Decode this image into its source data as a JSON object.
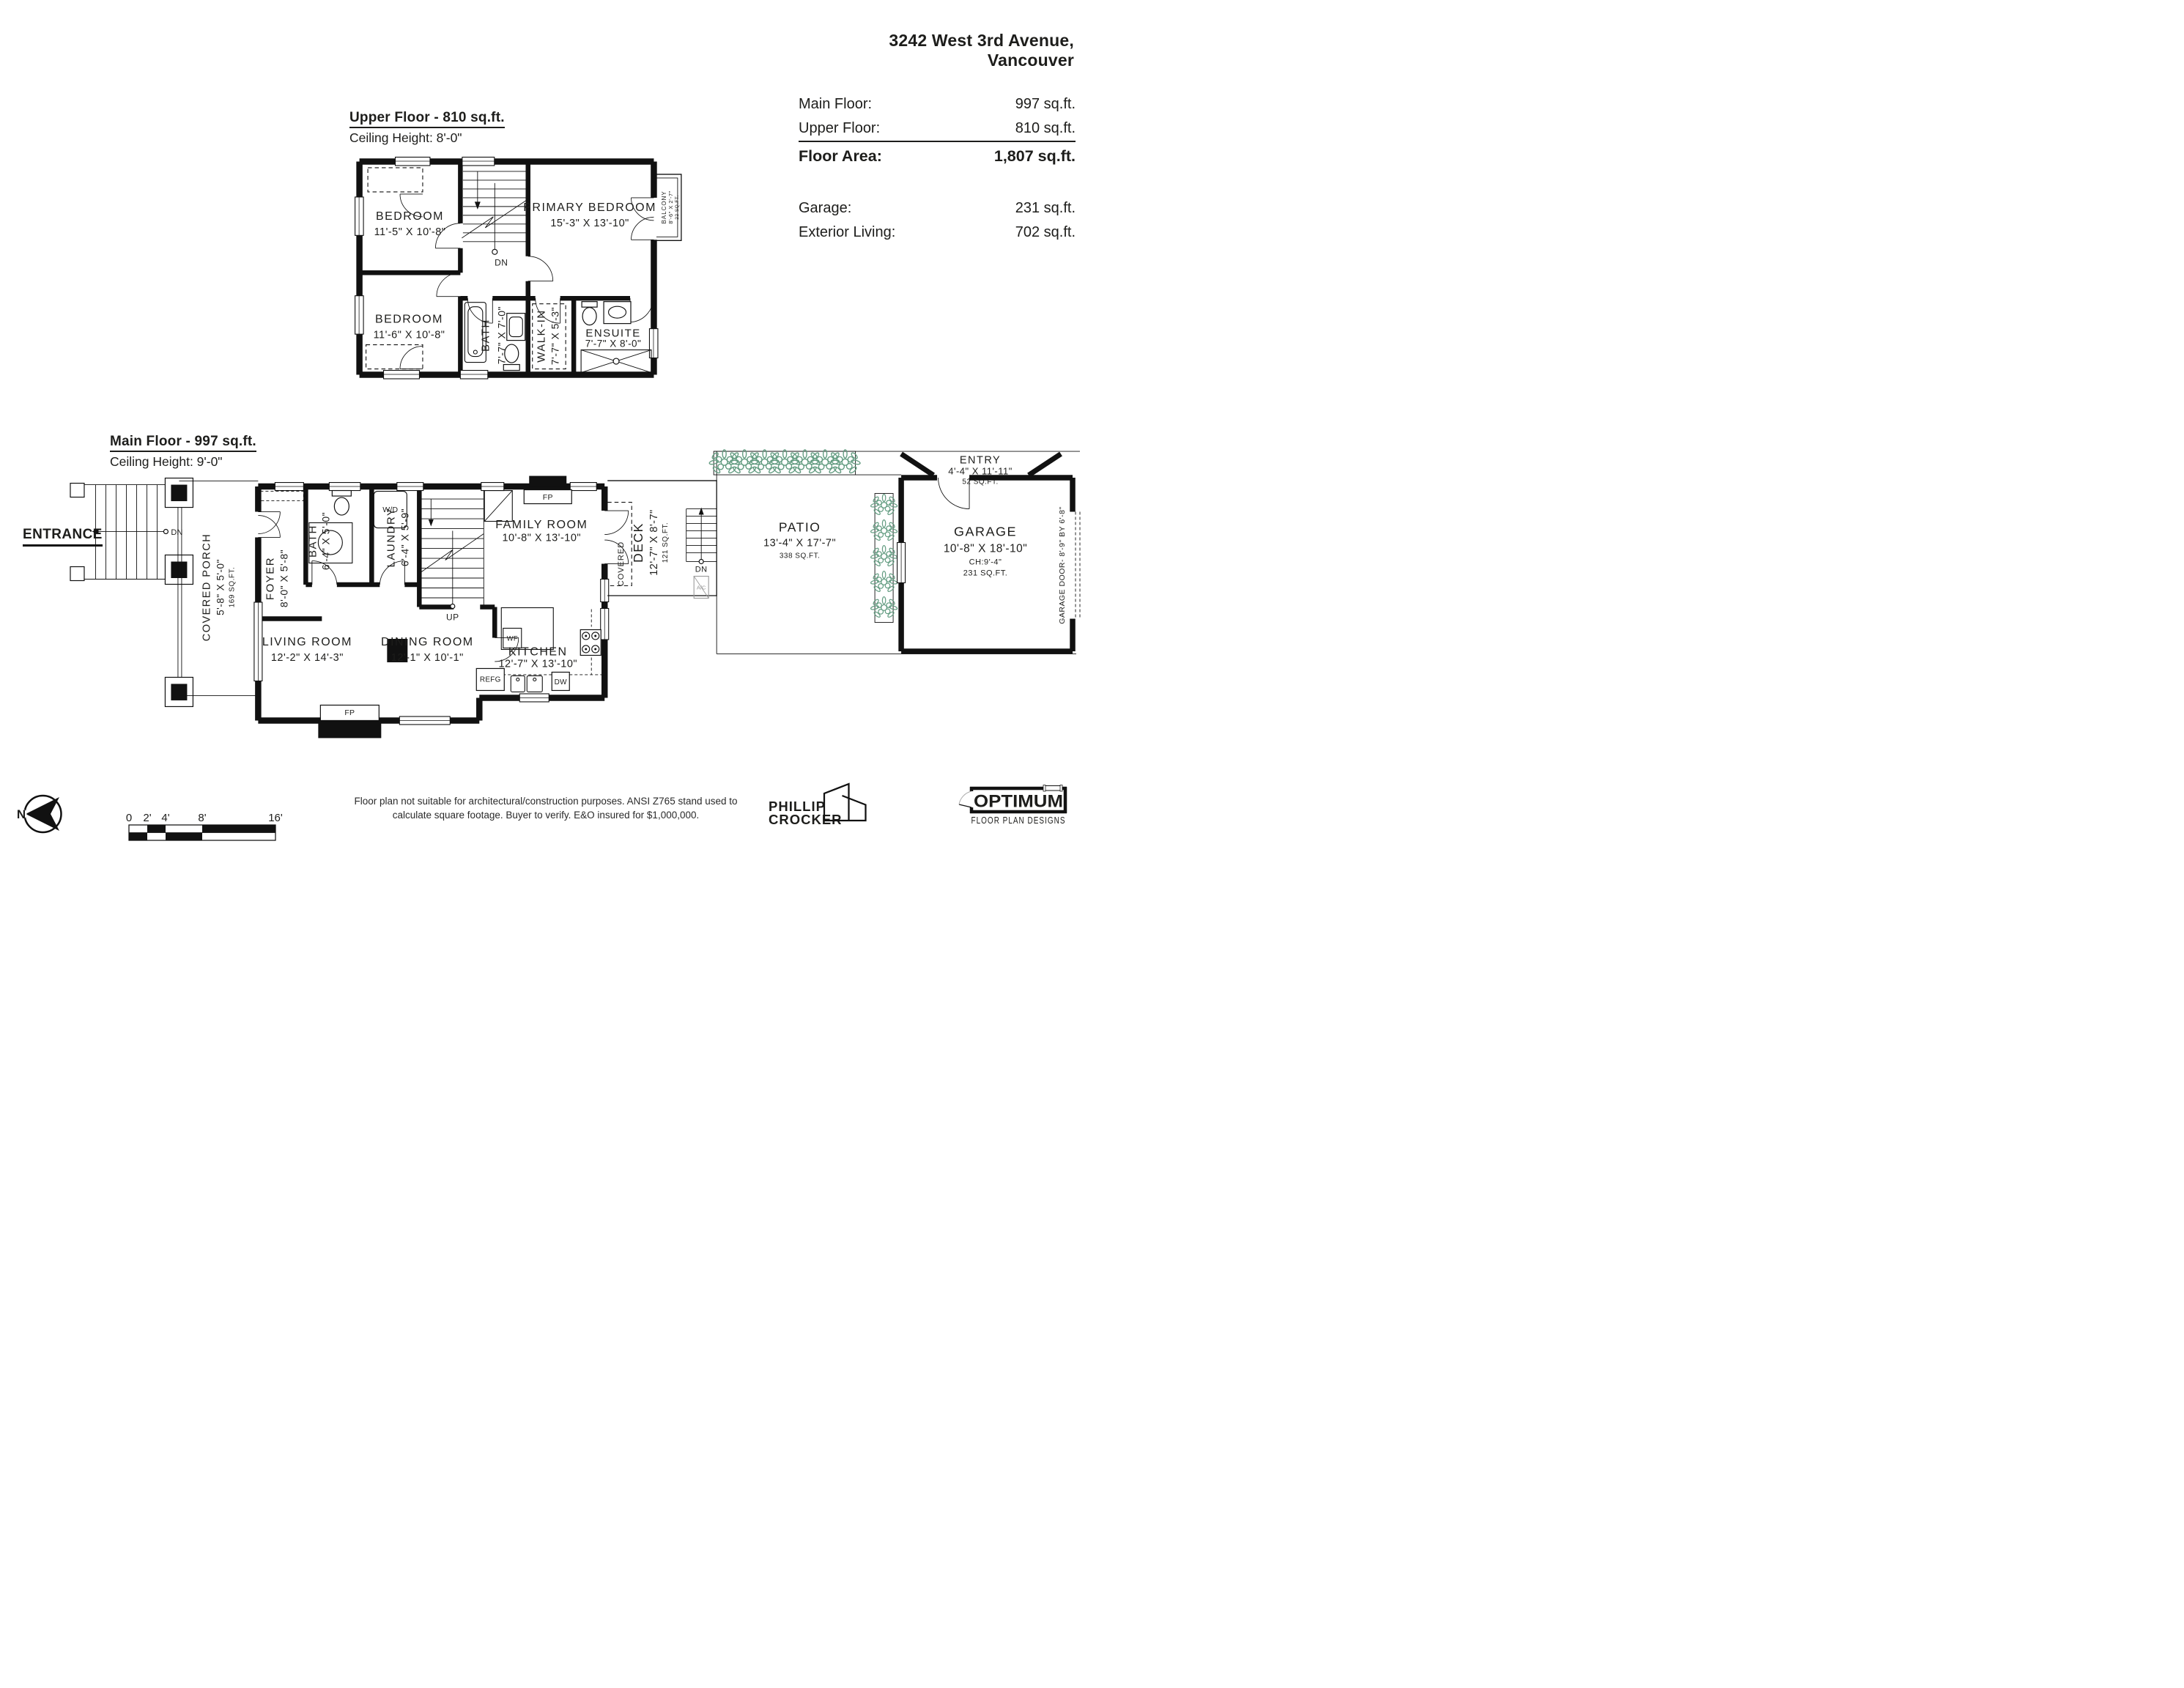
{
  "header": {
    "address_line1": "3242 West 3rd Avenue,",
    "address_line2": "Vancouver",
    "summary": [
      {
        "label": "Main Floor:",
        "value": "997 sq.ft."
      },
      {
        "label": "Upper Floor:",
        "value": "810 sq.ft."
      },
      {
        "label": "Floor Area:",
        "value": "1,807 sq.ft."
      },
      {
        "label": "Garage:",
        "value": "231 sq.ft."
      },
      {
        "label": "Exterior Living:",
        "value": "702 sq.ft."
      }
    ]
  },
  "upper_floor": {
    "title": "Upper Floor - 810 sq.ft.",
    "ceiling": "Ceiling Height: 8'-0\"",
    "stairs_label": "DN",
    "rooms": {
      "bedroom1": {
        "name": "BEDROOM",
        "dims": "11'-5\" X 10'-8\""
      },
      "bedroom2": {
        "name": "BEDROOM",
        "dims": "11'-6\" X 10'-8\""
      },
      "primary": {
        "name": "PRIMARY BEDROOM",
        "dims": "15'-3\" X 13'-10\""
      },
      "bath": {
        "name": "BATH",
        "dims": "7'-7\" X 7'-0\""
      },
      "walkin": {
        "name": "WALK-IN",
        "dims": "7'-7\" X 5'-3\""
      },
      "ensuite": {
        "name": "ENSUITE",
        "dims": "7'-7\" X 8'-0\""
      },
      "balcony": {
        "name": "BALCONY",
        "dims": "8'-6\" X 2'-7\"",
        "area": "22 SQ.FT."
      }
    }
  },
  "main_floor": {
    "title": "Main Floor - 997 sq.ft.",
    "ceiling": "Ceiling Height: 9'-0\"",
    "entrance_label": "ENTRANCE",
    "rooms": {
      "covered_porch": {
        "name": "COVERED PORCH",
        "dims": "5'-8\" X 5'-0\"",
        "area": "169 SQ.FT."
      },
      "foyer": {
        "name": "FOYER",
        "dims": "8'-0\" X 5'-8\""
      },
      "bath": {
        "name": "BATH",
        "dims": "6'-4\" X 5'-0\""
      },
      "laundry": {
        "name": "LAUNDRY",
        "dims": "6'-4\" X 5'-9\""
      },
      "living": {
        "name": "LIVING ROOM",
        "dims": "12'-2\" X 14'-3\""
      },
      "dining": {
        "name": "DINING ROOM",
        "dims": "12'-1\" X 10'-1\""
      },
      "family": {
        "name": "FAMILY ROOM",
        "dims": "10'-8\" X 13'-10\""
      },
      "kitchen": {
        "name": "KITCHEN",
        "dims": "12'-7\" X 13'-10\""
      },
      "deck": {
        "name": "DECK",
        "dims": "12'-7\" X 8'-7\"",
        "area": "121 SQ.FT."
      },
      "patio": {
        "name": "PATIO",
        "dims": "13'-4\" X 17'-7\"",
        "area": "338 SQ.FT."
      },
      "entry": {
        "name": "ENTRY",
        "dims": "4'-4\" X 11'-11\"",
        "area": "52 SQ.FT."
      },
      "garage": {
        "name": "GARAGE",
        "dims": "10'-8\" X 18'-10\"",
        "ceiling": "CH:9'-4\"",
        "area": "231 SQ.FT."
      }
    },
    "labels": {
      "up": "UP",
      "dn": "DN",
      "covered": "COVERED",
      "wd": "W/D",
      "fp": "FP",
      "wf": "WF",
      "refg": "REFG",
      "dw": "DW",
      "ac": "A/C",
      "garage_door": "GARAGE DOOR- 8'-9\" BY 6'-8\""
    }
  },
  "footer": {
    "north_label": "N",
    "scale_ticks": [
      "0",
      "2'",
      "4'",
      "8'",
      "16'"
    ],
    "disclaimer_line1": "Floor plan not suitable for architectural/construction purposes. ANSI Z765 stand used to",
    "disclaimer_line2": "calculate square footage. Buyer to verify.  E&O insured for $1,000,000.",
    "credit_line1": "PHILLIP",
    "credit_line2": "CROCKER",
    "brand_name": "OPTIMUM",
    "brand_tagline": "FLOOR PLAN DESIGNS"
  },
  "colors": {
    "line": "#111111",
    "text": "#1d1d1b",
    "plant_green": "#639c81",
    "muted": "#9a9a9a"
  }
}
